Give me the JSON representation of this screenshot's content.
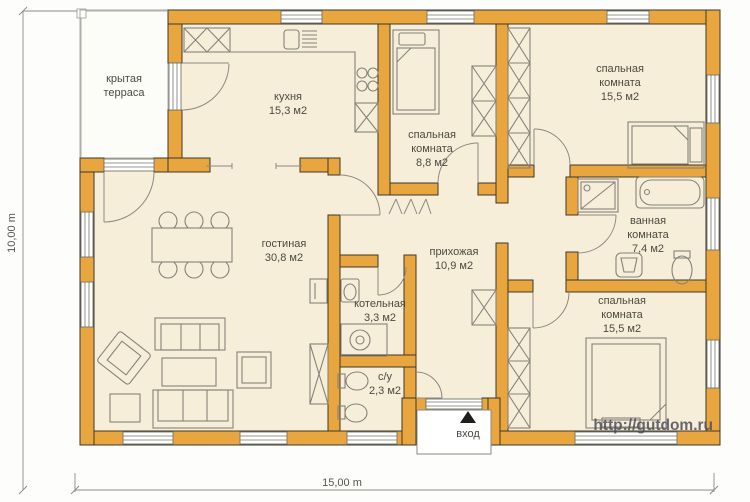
{
  "colors": {
    "wall": "#E9A63E",
    "wall-outline": "#3B382C",
    "floor": "#F7EEDA",
    "terrace-floor": "#FCFCF9",
    "furniture-line": "#84837A",
    "label-text": "#4B4A40",
    "watermark-text": "#4F4F5C"
  },
  "rooms": [
    {
      "id": "terrace",
      "line1": "крытая",
      "line2": "терраса",
      "area": ""
    },
    {
      "id": "kitchen",
      "line1": "кухня",
      "line2": "",
      "area": "15,3 м2"
    },
    {
      "id": "bedroom-small",
      "line1": "спальная",
      "line2": "комната",
      "area": "8,8 м2"
    },
    {
      "id": "bedroom-top-right",
      "line1": "спальная",
      "line2": "комната",
      "area": "15,5 м2"
    },
    {
      "id": "bathroom",
      "line1": "ванная",
      "line2": "комната",
      "area": "7,4 м2"
    },
    {
      "id": "bedroom-bottom-right",
      "line1": "спальная",
      "line2": "комната",
      "area": "15,5 м2"
    },
    {
      "id": "living-room",
      "line1": "гостиная",
      "line2": "",
      "area": "30,8 м2"
    },
    {
      "id": "hallway",
      "line1": "прихожая",
      "line2": "",
      "area": "10,9 м2"
    },
    {
      "id": "boiler-room",
      "line1": "котельная",
      "line2": "",
      "area": "3,3 м2"
    },
    {
      "id": "wc",
      "line1": "с/у",
      "line2": "",
      "area": "2,3 м2"
    }
  ],
  "entrance": {
    "label": "вход"
  },
  "dimensions": {
    "width": "15,00 m",
    "height": "10,00 m"
  },
  "watermark": "http://gutdom.ru"
}
